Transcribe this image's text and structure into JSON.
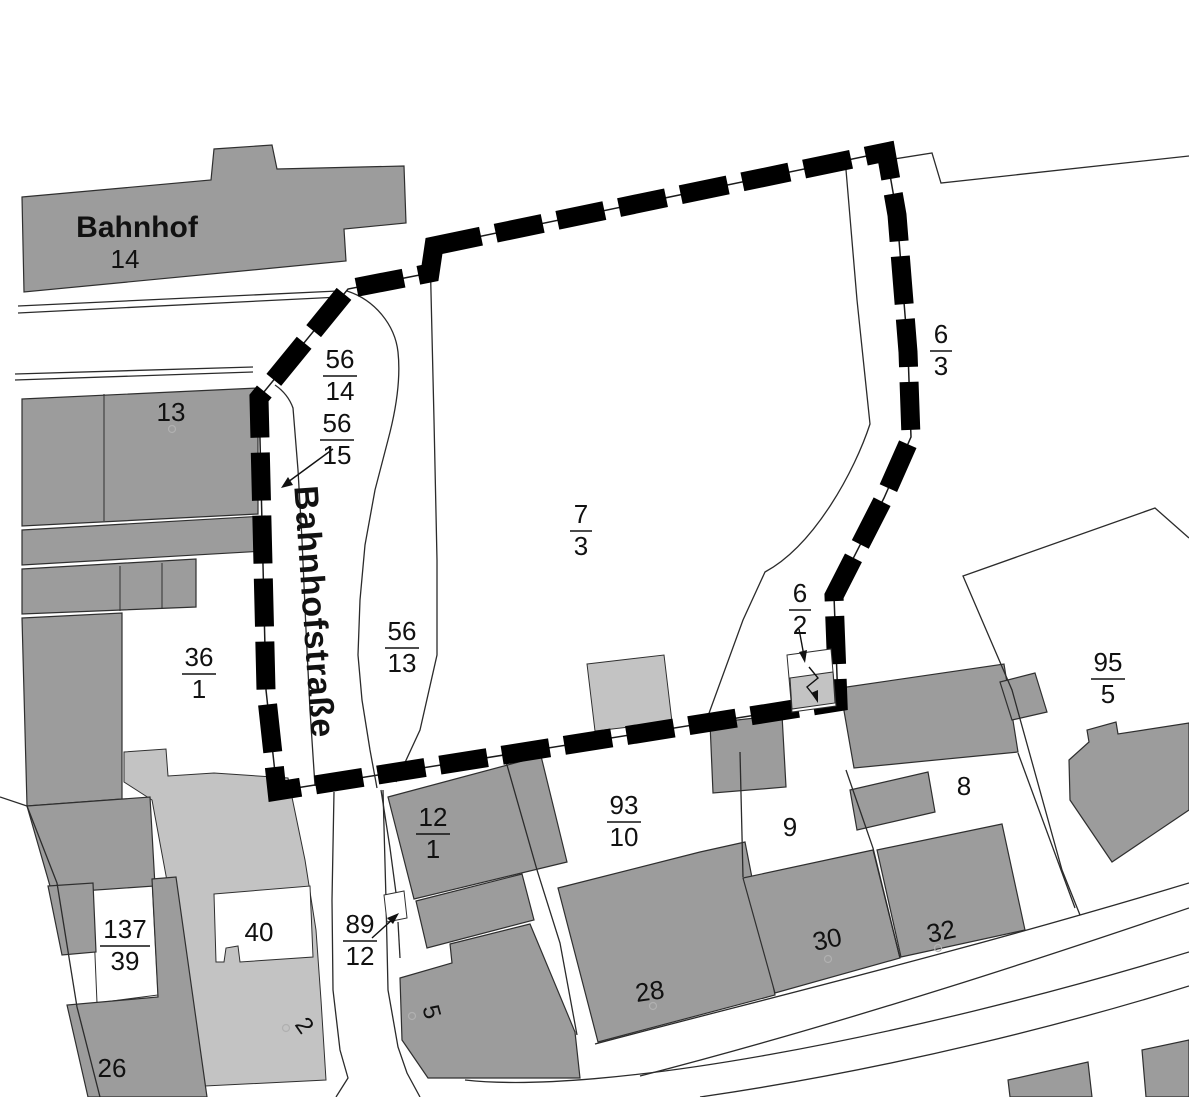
{
  "map": {
    "type": "cadastral-map",
    "station": {
      "name": "Bahnhof",
      "number": "14"
    },
    "street_name": "Bahnhofstraße",
    "fraction_parcels": [
      {
        "id": "56/14",
        "num": "56",
        "den": "14"
      },
      {
        "id": "56/15",
        "num": "56",
        "den": "15"
      },
      {
        "id": "56/13",
        "num": "56",
        "den": "13"
      },
      {
        "id": "7/3",
        "num": "7",
        "den": "3"
      },
      {
        "id": "6/3",
        "num": "6",
        "den": "3"
      },
      {
        "id": "6/2",
        "num": "6",
        "den": "2"
      },
      {
        "id": "36/1",
        "num": "36",
        "den": "1"
      },
      {
        "id": "95/5",
        "num": "95",
        "den": "5"
      },
      {
        "id": "93/10",
        "num": "93",
        "den": "10"
      },
      {
        "id": "12/1",
        "num": "12",
        "den": "1"
      },
      {
        "id": "137/39",
        "num": "137",
        "den": "39"
      },
      {
        "id": "89/12",
        "num": "89",
        "den": "12"
      }
    ],
    "plain_parcels": [
      {
        "id": "13",
        "label": "13"
      },
      {
        "id": "8",
        "label": "8"
      },
      {
        "id": "9",
        "label": "9"
      },
      {
        "id": "40",
        "label": "40"
      },
      {
        "id": "2",
        "label": "2"
      },
      {
        "id": "5",
        "label": "5"
      },
      {
        "id": "28",
        "label": "28"
      },
      {
        "id": "30",
        "label": "30"
      },
      {
        "id": "32",
        "label": "32"
      },
      {
        "id": "26",
        "label": "26"
      }
    ],
    "symbols": {
      "transformer_station": "lightning-bolt"
    },
    "colors": {
      "building_gray": "#9c9c9c",
      "light_gray": "#c3c3c3",
      "outline": "#2f2f2f",
      "boundary": "#000000",
      "background": "#ffffff",
      "text": "#111111"
    }
  }
}
